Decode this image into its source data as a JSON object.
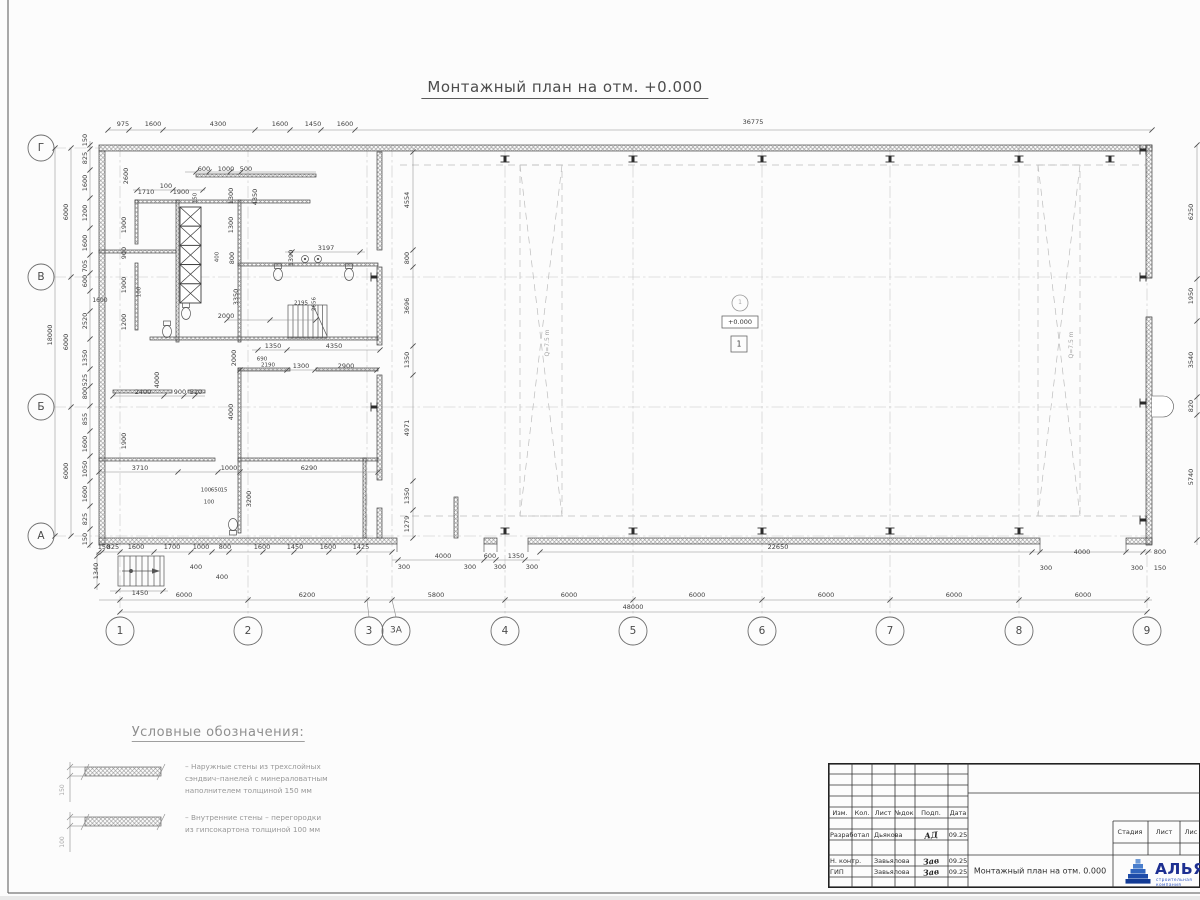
{
  "title": "Монтажный план на отм. +0.000",
  "annotations": {
    "level_mark": "+0.000",
    "zone_circle": "1",
    "zone_square": "1",
    "crane_left": "Q=7.5 m",
    "crane_right": "Q=7.5 m"
  },
  "axes": {
    "bottom": [
      "1",
      "2",
      "3",
      "3А",
      "4",
      "5",
      "6",
      "7",
      "8",
      "9"
    ],
    "left": [
      "Г",
      "В",
      "Б",
      "А"
    ]
  },
  "legend": {
    "title": "Условные обозначения:",
    "item1": "– Наружные стены из трехслойных\nсэндвич–панелей с минераловатным\nнаполнителем толщиной 150 мм",
    "item2": "– Внутренние стены – перегородки\nиз гипсокартона толщиной 100 мм"
  },
  "titleblock": {
    "header_cols": [
      "Изм.",
      "Кол.",
      "Лист",
      "№док",
      "Подп.",
      "Дата"
    ],
    "rows": [
      {
        "role": "Разработал",
        "name": "Дьякова",
        "sig": "АД",
        "date": "09.25"
      },
      {
        "role": "Н. контр.",
        "name": "Завьялова",
        "sig": "Зав",
        "date": "09.25"
      },
      {
        "role": "ГИП",
        "name": "Завьялова",
        "sig": "Зав",
        "date": "09.25"
      }
    ],
    "doc_title": "Монтажный план на отм. 0.000",
    "stage_cols": [
      "Стадия",
      "Лист",
      "Лис"
    ],
    "logo_text": "АЛЬЯНС",
    "logo_sub": "строительная компания",
    "logo_color": "#1d2f91"
  },
  "labels": [
    {
      "t": "975",
      "x": 123,
      "y": 124
    },
    {
      "t": "1600",
      "x": 153,
      "y": 124
    },
    {
      "t": "4300",
      "x": 218,
      "y": 124
    },
    {
      "t": "1600",
      "x": 280,
      "y": 124
    },
    {
      "t": "1450",
      "x": 313,
      "y": 124
    },
    {
      "t": "1600",
      "x": 345,
      "y": 124
    },
    {
      "t": "36775",
      "x": 753,
      "y": 122
    },
    {
      "t": "150",
      "x": 85,
      "y": 140,
      "r": 1
    },
    {
      "t": "825",
      "x": 85,
      "y": 158,
      "r": 1
    },
    {
      "t": "1600",
      "x": 85,
      "y": 183,
      "r": 1
    },
    {
      "t": "1200",
      "x": 85,
      "y": 213,
      "r": 1
    },
    {
      "t": "1600",
      "x": 85,
      "y": 243,
      "r": 1
    },
    {
      "t": "705",
      "x": 85,
      "y": 266,
      "r": 1
    },
    {
      "t": "600",
      "x": 85,
      "y": 281,
      "r": 1
    },
    {
      "t": "1600",
      "x": 100,
      "y": 301,
      "s": 6
    },
    {
      "t": "2520",
      "x": 85,
      "y": 321,
      "r": 1
    },
    {
      "t": "1350",
      "x": 85,
      "y": 358,
      "r": 1
    },
    {
      "t": "525",
      "x": 85,
      "y": 380,
      "r": 1
    },
    {
      "t": "800",
      "x": 85,
      "y": 393,
      "r": 1
    },
    {
      "t": "855",
      "x": 85,
      "y": 419,
      "r": 1
    },
    {
      "t": "1600",
      "x": 85,
      "y": 444,
      "r": 1
    },
    {
      "t": "1050",
      "x": 85,
      "y": 469,
      "r": 1
    },
    {
      "t": "1600",
      "x": 85,
      "y": 494,
      "r": 1
    },
    {
      "t": "825",
      "x": 85,
      "y": 519,
      "r": 1
    },
    {
      "t": "150",
      "x": 85,
      "y": 539,
      "r": 1
    },
    {
      "t": "6000",
      "x": 66,
      "y": 212,
      "r": 1
    },
    {
      "t": "6000",
      "x": 66,
      "y": 342,
      "r": 1
    },
    {
      "t": "6000",
      "x": 66,
      "y": 471,
      "r": 1
    },
    {
      "t": "18000",
      "x": 50,
      "y": 335,
      "r": 1
    },
    {
      "t": "6250",
      "x": 1191,
      "y": 212,
      "r": 1
    },
    {
      "t": "1950",
      "x": 1191,
      "y": 296,
      "r": 1
    },
    {
      "t": "3540",
      "x": 1191,
      "y": 360,
      "r": 1
    },
    {
      "t": "820",
      "x": 1191,
      "y": 406,
      "r": 1
    },
    {
      "t": "5740",
      "x": 1191,
      "y": 477,
      "r": 1
    },
    {
      "t": "4554",
      "x": 407,
      "y": 200,
      "r": 1
    },
    {
      "t": "800",
      "x": 407,
      "y": 258,
      "r": 1
    },
    {
      "t": "3696",
      "x": 407,
      "y": 306,
      "r": 1
    },
    {
      "t": "1350",
      "x": 407,
      "y": 360,
      "r": 1
    },
    {
      "t": "4971",
      "x": 407,
      "y": 428,
      "r": 1
    },
    {
      "t": "1350",
      "x": 407,
      "y": 496,
      "r": 1
    },
    {
      "t": "1279",
      "x": 407,
      "y": 524,
      "r": 1
    },
    {
      "t": "150",
      "x": 104,
      "y": 547
    },
    {
      "t": "825",
      "x": 113,
      "y": 547
    },
    {
      "t": "1600",
      "x": 136,
      "y": 547
    },
    {
      "t": "1700",
      "x": 172,
      "y": 547
    },
    {
      "t": "1000",
      "x": 201,
      "y": 547
    },
    {
      "t": "800",
      "x": 225,
      "y": 547
    },
    {
      "t": "400",
      "x": 196,
      "y": 567
    },
    {
      "t": "400",
      "x": 222,
      "y": 577
    },
    {
      "t": "1600",
      "x": 262,
      "y": 547
    },
    {
      "t": "1450",
      "x": 295,
      "y": 547
    },
    {
      "t": "1600",
      "x": 328,
      "y": 547
    },
    {
      "t": "1425",
      "x": 361,
      "y": 547
    },
    {
      "t": "4000",
      "x": 443,
      "y": 556
    },
    {
      "t": "600",
      "x": 490,
      "y": 556
    },
    {
      "t": "1350",
      "x": 516,
      "y": 556
    },
    {
      "t": "300",
      "x": 404,
      "y": 567
    },
    {
      "t": "300",
      "x": 470,
      "y": 567
    },
    {
      "t": "300",
      "x": 500,
      "y": 567
    },
    {
      "t": "300",
      "x": 532,
      "y": 567
    },
    {
      "t": "22650",
      "x": 778,
      "y": 547
    },
    {
      "t": "4000",
      "x": 1082,
      "y": 552
    },
    {
      "t": "300",
      "x": 1046,
      "y": 568
    },
    {
      "t": "300",
      "x": 1137,
      "y": 568
    },
    {
      "t": "800",
      "x": 1160,
      "y": 552
    },
    {
      "t": "150",
      "x": 1160,
      "y": 568
    },
    {
      "t": "6000",
      "x": 184,
      "y": 595
    },
    {
      "t": "6200",
      "x": 307,
      "y": 595
    },
    {
      "t": "5800",
      "x": 436,
      "y": 595
    },
    {
      "t": "6000",
      "x": 569,
      "y": 595
    },
    {
      "t": "6000",
      "x": 697,
      "y": 595
    },
    {
      "t": "6000",
      "x": 826,
      "y": 595
    },
    {
      "t": "6000",
      "x": 954,
      "y": 595
    },
    {
      "t": "6000",
      "x": 1083,
      "y": 595
    },
    {
      "t": "48000",
      "x": 633,
      "y": 607
    },
    {
      "t": "1340",
      "x": 96,
      "y": 571,
      "r": 1
    },
    {
      "t": "1450",
      "x": 140,
      "y": 593
    },
    {
      "t": "2600",
      "x": 126,
      "y": 176,
      "r": 1
    },
    {
      "t": "600",
      "x": 204,
      "y": 169
    },
    {
      "t": "1000",
      "x": 226,
      "y": 169
    },
    {
      "t": "500",
      "x": 246,
      "y": 169
    },
    {
      "t": "100",
      "x": 166,
      "y": 186
    },
    {
      "t": "1710",
      "x": 146,
      "y": 192
    },
    {
      "t": "1900",
      "x": 181,
      "y": 192
    },
    {
      "t": "150",
      "x": 196,
      "y": 198,
      "r": 1,
      "s": 5.5
    },
    {
      "t": "1300",
      "x": 231,
      "y": 196,
      "r": 1
    },
    {
      "t": "1300",
      "x": 231,
      "y": 225,
      "r": 1
    },
    {
      "t": "4350",
      "x": 255,
      "y": 197,
      "r": 1
    },
    {
      "t": "1900",
      "x": 124,
      "y": 225,
      "r": 1
    },
    {
      "t": "900",
      "x": 124,
      "y": 253,
      "r": 1
    },
    {
      "t": "1900",
      "x": 124,
      "y": 285,
      "r": 1
    },
    {
      "t": "100",
      "x": 140,
      "y": 292,
      "r": 1,
      "s": 5.5
    },
    {
      "t": "1200",
      "x": 124,
      "y": 322,
      "r": 1
    },
    {
      "t": "400",
      "x": 218,
      "y": 257,
      "r": 1,
      "s": 5.5
    },
    {
      "t": "800",
      "x": 232,
      "y": 258,
      "r": 1
    },
    {
      "t": "3350",
      "x": 236,
      "y": 297,
      "r": 1
    },
    {
      "t": "2000",
      "x": 226,
      "y": 316
    },
    {
      "t": "1390",
      "x": 291,
      "y": 258,
      "r": 1
    },
    {
      "t": "3197",
      "x": 326,
      "y": 248
    },
    {
      "t": "2195",
      "x": 301,
      "y": 304,
      "s": 5.5
    },
    {
      "t": "2656",
      "x": 315,
      "y": 304,
      "r": 1,
      "s": 5.5
    },
    {
      "t": "1350",
      "x": 273,
      "y": 346
    },
    {
      "t": "4350",
      "x": 334,
      "y": 346
    },
    {
      "t": "690",
      "x": 262,
      "y": 360,
      "s": 5.5
    },
    {
      "t": "2190",
      "x": 268,
      "y": 366,
      "s": 5.5
    },
    {
      "t": "1300",
      "x": 301,
      "y": 366
    },
    {
      "t": "2900",
      "x": 346,
      "y": 366
    },
    {
      "t": "2000",
      "x": 234,
      "y": 358,
      "r": 1
    },
    {
      "t": "4000",
      "x": 157,
      "y": 380,
      "r": 1
    },
    {
      "t": "2400",
      "x": 143,
      "y": 392
    },
    {
      "t": "900",
      "x": 180,
      "y": 392
    },
    {
      "t": "510",
      "x": 196,
      "y": 392
    },
    {
      "t": "1900",
      "x": 124,
      "y": 441,
      "r": 1
    },
    {
      "t": "3710",
      "x": 140,
      "y": 468
    },
    {
      "t": "1000",
      "x": 229,
      "y": 468
    },
    {
      "t": "6290",
      "x": 309,
      "y": 468
    },
    {
      "t": "100",
      "x": 206,
      "y": 491,
      "s": 5.5
    },
    {
      "t": "650",
      "x": 216,
      "y": 491,
      "s": 5.5
    },
    {
      "t": "15",
      "x": 224,
      "y": 491,
      "s": 5.5
    },
    {
      "t": "100",
      "x": 209,
      "y": 503,
      "s": 5.5
    },
    {
      "t": "4000",
      "x": 231,
      "y": 412,
      "r": 1
    },
    {
      "t": "3200",
      "x": 249,
      "y": 499,
      "r": 1
    },
    {
      "t": "1",
      "x": 740,
      "y": 303,
      "c": "a"
    },
    {
      "t": "+0.000",
      "x": 740,
      "y": 322,
      "c": "lv"
    },
    {
      "t": "1",
      "x": 739,
      "y": 344,
      "c": "lv",
      "s": 7.5
    },
    {
      "t": "Q=7.5 m",
      "x": 548,
      "y": 343,
      "r": 1,
      "c": "a"
    },
    {
      "t": "Q=7.5 m",
      "x": 1072,
      "y": 345,
      "r": 1,
      "c": "a"
    },
    {
      "t": "150",
      "x": 63,
      "y": 790,
      "r": 1,
      "c": "a"
    },
    {
      "t": "100",
      "x": 63,
      "y": 842,
      "r": 1,
      "c": "a"
    },
    {
      "t": "1",
      "x": 120,
      "y": 631,
      "c": "b"
    },
    {
      "t": "2",
      "x": 248,
      "y": 631,
      "c": "b"
    },
    {
      "t": "3",
      "x": 369,
      "y": 631,
      "c": "b"
    },
    {
      "t": "3А",
      "x": 396,
      "y": 631,
      "c": "b",
      "s": 9
    },
    {
      "t": "4",
      "x": 505,
      "y": 631,
      "c": "b"
    },
    {
      "t": "5",
      "x": 633,
      "y": 631,
      "c": "b"
    },
    {
      "t": "6",
      "x": 762,
      "y": 631,
      "c": "b"
    },
    {
      "t": "7",
      "x": 890,
      "y": 631,
      "c": "b"
    },
    {
      "t": "8",
      "x": 1019,
      "y": 631,
      "c": "b"
    },
    {
      "t": "9",
      "x": 1147,
      "y": 631,
      "c": "b"
    },
    {
      "t": "Г",
      "x": 41,
      "y": 148,
      "c": "b"
    },
    {
      "t": "В",
      "x": 41,
      "y": 277,
      "c": "b"
    },
    {
      "t": "Б",
      "x": 41,
      "y": 407,
      "c": "b"
    },
    {
      "t": "А",
      "x": 41,
      "y": 536,
      "c": "b"
    }
  ],
  "dim_chains": [
    {
      "o": "h",
      "y": 130,
      "a": 108,
      "b": 1152,
      "t": [
        108,
        129,
        163,
        255,
        290,
        321,
        355,
        1152
      ]
    },
    {
      "o": "h",
      "y": 552,
      "a": 99,
      "b": 392,
      "t": [
        99,
        102,
        120,
        154,
        191,
        212,
        229,
        263,
        294,
        329,
        359,
        392
      ]
    },
    {
      "o": "h",
      "y": 560,
      "a": 392,
      "b": 540,
      "t": [
        398,
        484,
        496,
        525
      ]
    },
    {
      "o": "h",
      "y": 552,
      "a": 540,
      "b": 1152,
      "t": [
        540,
        1032,
        1040,
        1126,
        1143,
        1148
      ]
    },
    {
      "o": "h",
      "y": 600,
      "a": 99,
      "b": 1152,
      "t": [
        120,
        248,
        367,
        392,
        505,
        633,
        762,
        890,
        1019,
        1147
      ]
    },
    {
      "o": "h",
      "y": 612,
      "a": 120,
      "b": 1147,
      "t": [
        120,
        1147
      ]
    },
    {
      "o": "v",
      "x": 90,
      "a": 141,
      "b": 548,
      "t": [
        145,
        149,
        170,
        198,
        228,
        255,
        273,
        291,
        311,
        339,
        369,
        386,
        406,
        431,
        456,
        481,
        506,
        529,
        545
      ]
    },
    {
      "o": "v",
      "x": 71,
      "a": 148,
      "b": 536,
      "t": [
        148,
        277,
        407,
        536
      ]
    },
    {
      "o": "v",
      "x": 55,
      "a": 148,
      "b": 536,
      "t": [
        148,
        536
      ]
    },
    {
      "o": "v",
      "x": 1197,
      "a": 145,
      "b": 545,
      "t": [
        145,
        279,
        321,
        397,
        415,
        540
      ]
    },
    {
      "o": "v",
      "x": 413,
      "a": 152,
      "b": 538,
      "t": [
        152,
        250,
        267,
        346,
        375,
        481,
        510,
        538
      ]
    },
    {
      "o": "h",
      "y": 172,
      "a": 185,
      "b": 316,
      "t": [
        196,
        209,
        230,
        241
      ]
    },
    {
      "o": "h",
      "y": 190,
      "a": 133,
      "b": 205,
      "t": [
        137,
        173,
        203
      ]
    },
    {
      "o": "h",
      "y": 320,
      "a": 227,
      "b": 316,
      "t": [
        227,
        270,
        316
      ]
    },
    {
      "o": "h",
      "y": 350,
      "a": 252,
      "b": 380,
      "t": [
        258,
        287,
        380
      ]
    },
    {
      "o": "h",
      "y": 370,
      "a": 240,
      "b": 378,
      "t": [
        240,
        287,
        315,
        377
      ]
    },
    {
      "o": "h",
      "y": 396,
      "a": 113,
      "b": 205,
      "t": [
        113,
        164,
        184,
        195
      ]
    },
    {
      "o": "h",
      "y": 472,
      "a": 99,
      "b": 378,
      "t": [
        99,
        178,
        218,
        240,
        378
      ]
    },
    {
      "o": "h",
      "y": 252,
      "a": 285,
      "b": 365,
      "t": [
        292,
        360
      ]
    },
    {
      "o": "v",
      "x": 97,
      "a": 552,
      "b": 590,
      "t": [
        556,
        586
      ]
    },
    {
      "o": "h",
      "y": 591,
      "a": 110,
      "b": 168,
      "t": [
        118,
        163
      ]
    }
  ]
}
